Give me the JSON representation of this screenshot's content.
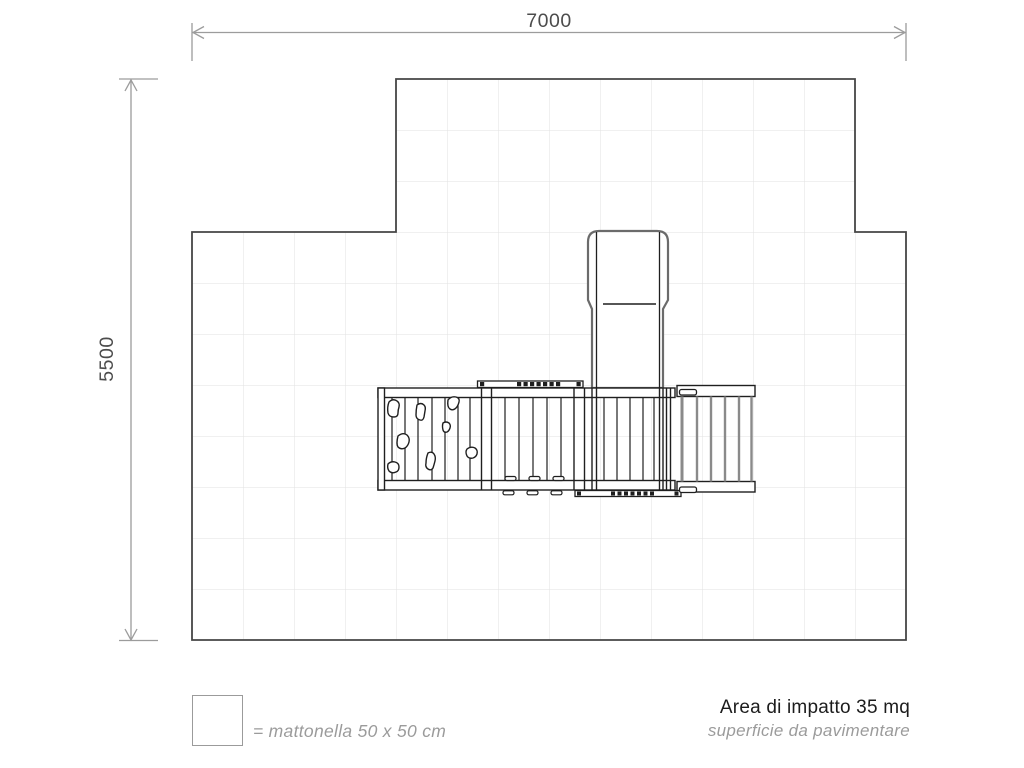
{
  "dimension_labels": {
    "width": "7000",
    "height": "5500"
  },
  "legend": {
    "tile_note": "= mattonella 50 x 50 cm"
  },
  "footer": {
    "title": "Area di impatto 35 mq",
    "subtitle": "superficie da pavimentare"
  },
  "diagram": {
    "kind": "playground impact area plan (top view)",
    "impact_area_mq": "35",
    "tile_size_cm": "50 x 50",
    "grid": {
      "columns": 14,
      "rows": 11
    }
  },
  "colors": {
    "dimension_lines": "#9c9c9c",
    "grid_lines": "#e2e2e2",
    "area_outline": "#464646",
    "equipment_lines": "#1f1f1f",
    "ladder_gray": "#8a8a8a",
    "dark_text": "#1c1c1c",
    "muted_text": "#9b9b9b"
  }
}
